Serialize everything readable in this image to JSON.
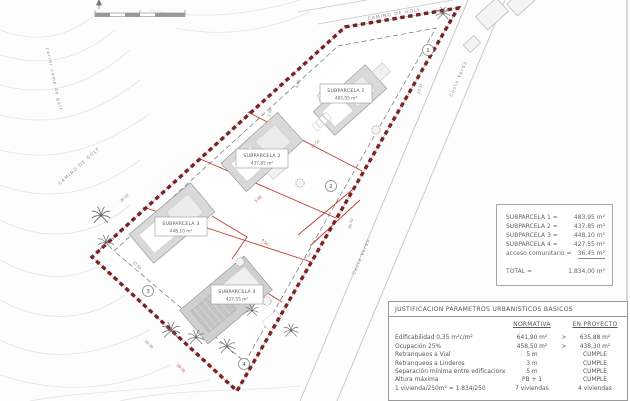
{
  "plan": {
    "street_labels": [
      {
        "text": "CAMINO DE GOLF"
      },
      {
        "text": "CAMINO DE GOLF"
      },
      {
        "text": "carrer camp de golf"
      },
      {
        "text": "Costa Verda"
      },
      {
        "text": "Costa Verda"
      }
    ],
    "subparcels": [
      {
        "name": "SUBPARCELA 1",
        "area": "483,95 m²",
        "marker": "1"
      },
      {
        "name": "SUBPARCELA 2",
        "area": "437,85 m²",
        "marker": "2"
      },
      {
        "name": "SUBPARCELA 3",
        "area": "448,10 m²",
        "marker": "3"
      },
      {
        "name": "SUBPARCELA 4",
        "area": "427,55 m²",
        "marker": "4"
      }
    ],
    "dimensions_black": [
      "6.00",
      "27.35",
      "3.00",
      "12.50",
      "26.10",
      "32.50",
      "36.70",
      "16.30",
      "5.00"
    ],
    "dimensions_red": [
      "5.00",
      "4.50",
      "18.35"
    ],
    "colors": {
      "boundary": "#7b2323",
      "parcel_lines": "#c23b2e",
      "building_fill": "#d9d9d9",
      "contour": "#e3e3e3"
    }
  },
  "legend": {
    "rows": [
      {
        "label": "SUBPARCELA 1 =",
        "value": "483,95 m²"
      },
      {
        "label": "SUBPARCELA 2 =",
        "value": "437,85 m²"
      },
      {
        "label": "SUBPARCELA 3 =",
        "value": "448,10 m²"
      },
      {
        "label": "SUBPARCELA 4 =",
        "value": "427,55 m²"
      },
      {
        "label": "acceso comunitario =",
        "value": "36,45 m²"
      }
    ],
    "total_label": "TOTAL =",
    "total_value": "1.834,00 m²"
  },
  "table": {
    "title": "JUSTIFICACION PARAMETROS URBANISTICOS BASICOS",
    "columns": {
      "normativa": "NORMATIVA",
      "proyecto": "EN PROYECTO"
    },
    "rows": [
      {
        "label": "Edificabilidad 0,35 m²c/m²",
        "normativa": "641,90 m²",
        "comp": ">",
        "proyecto": "635,88 m²"
      },
      {
        "label": "Ocupación 25%",
        "normativa": "458,50 m²",
        "comp": ">",
        "proyecto": "438,30 m²"
      },
      {
        "label": "Retranqueos a Vial",
        "normativa": "5 m",
        "comp": "",
        "proyecto": "CUMPLE"
      },
      {
        "label": "Retranqueos a Linderos",
        "normativa": "3 m",
        "comp": "",
        "proyecto": "CUMPLE"
      },
      {
        "label": "Separación mínima entre edificaciones",
        "normativa": "5 m",
        "comp": "",
        "proyecto": "CUMPLE"
      },
      {
        "label": "Altura máxima",
        "normativa": "PB + 1",
        "comp": "",
        "proyecto": "CUMPLE"
      },
      {
        "label": "1 vivienda/250m² = 1.834/250",
        "normativa": "7 viviendas",
        "comp": "",
        "proyecto": "4 viviendas"
      }
    ]
  }
}
